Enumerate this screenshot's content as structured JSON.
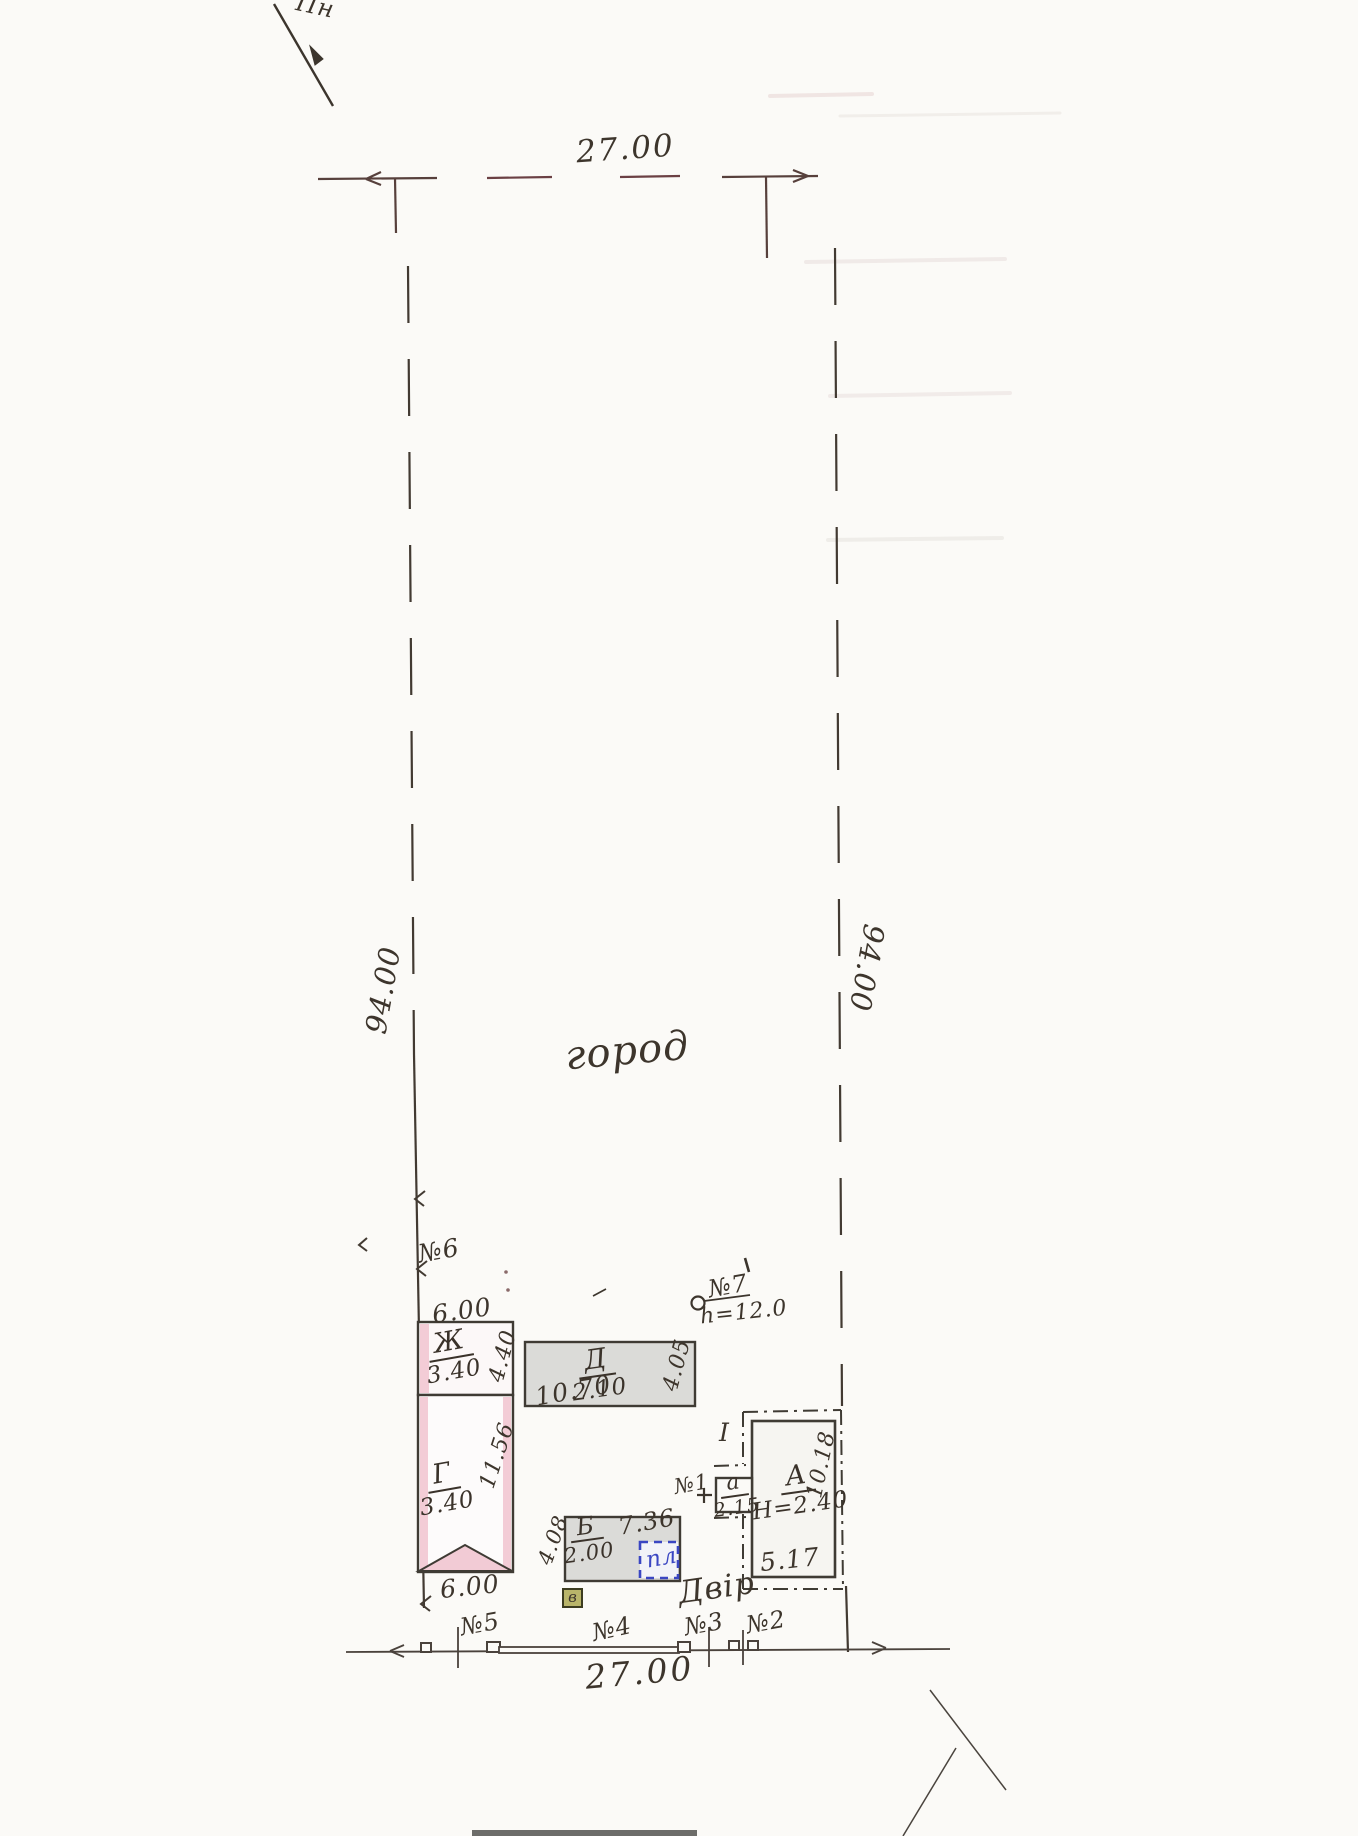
{
  "plan": {
    "north_label": "Пн",
    "dimensions": {
      "top_width": "27.00",
      "bottom_width": "27.00",
      "left_side": "94.00",
      "right_side": "94.00"
    },
    "areas": {
      "garden": "город",
      "yard": "Двір"
    },
    "survey_points": {
      "p1": "№1",
      "p2": "№2",
      "p3": "№3",
      "p4": "№4",
      "p5": "№5",
      "p6": "№6",
      "p7": "№7",
      "p7_height": "h=12.0"
    },
    "buildings": {
      "zh": {
        "letter": "Ж",
        "height": "3.40",
        "width_top": "6.00",
        "depth": "4.40"
      },
      "d": {
        "letter": "Д",
        "height": "2.10",
        "length": "10.70",
        "depth": "4.05"
      },
      "g": {
        "letter": "Г",
        "height": "3.40",
        "length": "11.56",
        "width_bottom": "6.00"
      },
      "b": {
        "letter": "Б",
        "height": "2.00",
        "length": "7.36",
        "depth": "4.08",
        "slab_label": "пл"
      },
      "v": {
        "letter": "в"
      },
      "a_house": {
        "letter": "А",
        "height": "Н=2.40",
        "width": "5.17",
        "length": "10.18",
        "section": "І"
      },
      "a_porch": {
        "letter": "а",
        "height": "2.15"
      }
    },
    "colors": {
      "ink": "#3c352d",
      "pink_fill": "#f3ccd6",
      "gray_fill": "#dbdbd8",
      "blue_accent": "#3a46c2",
      "khaki_fill": "#b9b56a"
    }
  }
}
